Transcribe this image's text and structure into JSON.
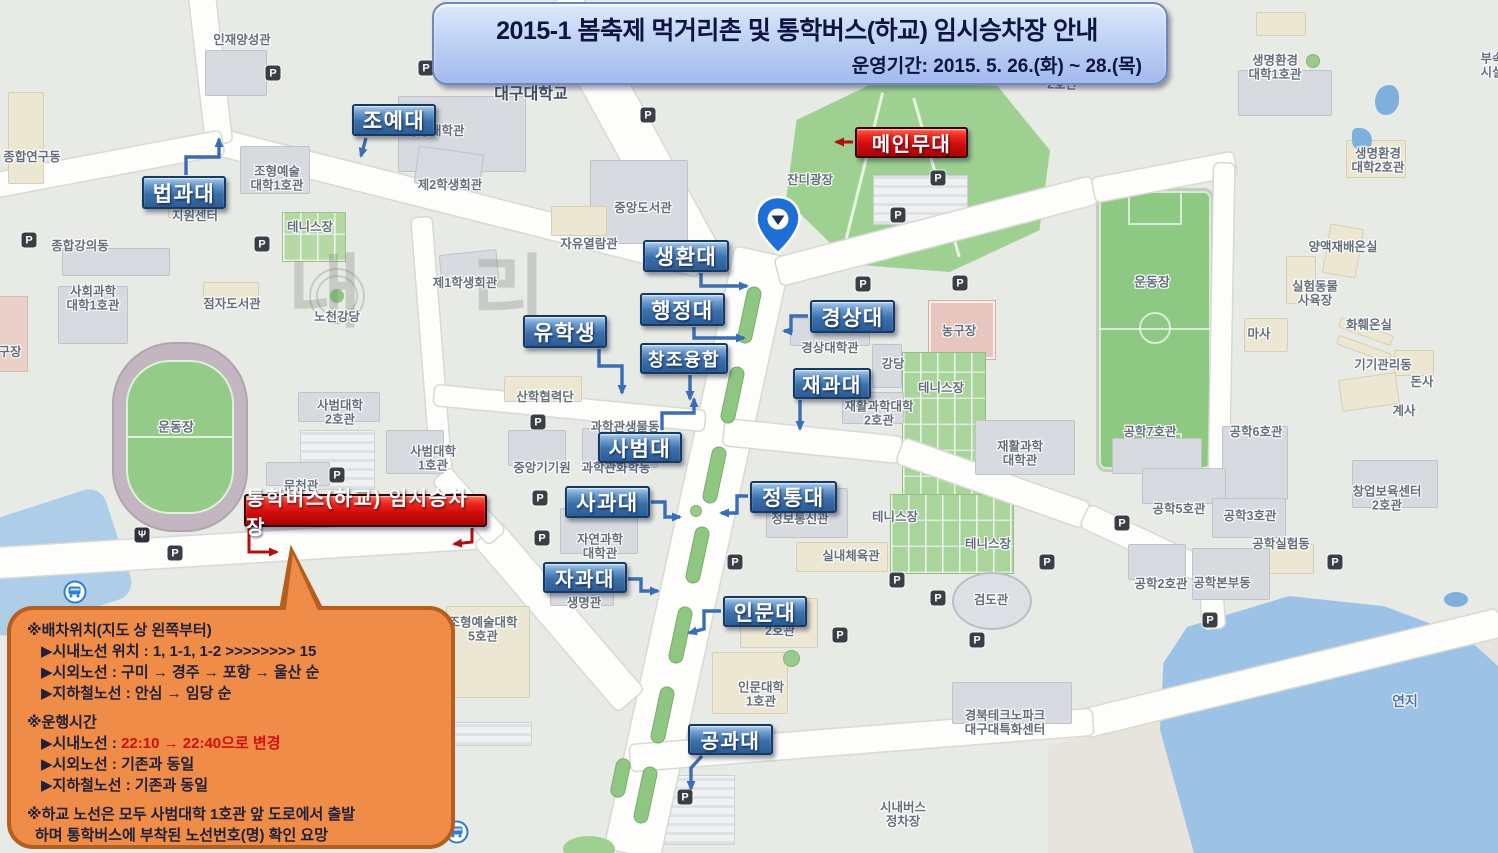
{
  "banner": {
    "title": "2015-1 봄축제 먹거리촌 및 통학버스(하교) 임시승차장 안내",
    "subtitle": "운영기간: 2015. 5. 26.(화) ~ 28.(목)"
  },
  "colors": {
    "label_blue": "#3c70aa",
    "label_red": "#d40d0d",
    "callout_orange": "#ee8c48",
    "field_green": "#8ec983",
    "water_blue": "#9cc2e6"
  },
  "overlays": {
    "blue": [
      {
        "t": "조예대",
        "x": 352,
        "y": 104,
        "w": 84,
        "h": 32
      },
      {
        "t": "법과대",
        "x": 142,
        "y": 176,
        "w": 84,
        "h": 33
      },
      {
        "t": "생환대",
        "x": 643,
        "y": 240,
        "w": 86,
        "h": 32
      },
      {
        "t": "행정대",
        "x": 640,
        "y": 293,
        "w": 85,
        "h": 33
      },
      {
        "t": "유학생",
        "x": 523,
        "y": 315,
        "w": 84,
        "h": 33
      },
      {
        "t": "창조융합",
        "x": 640,
        "y": 343,
        "w": 88,
        "h": 31,
        "fs": 18
      },
      {
        "t": "경상대",
        "x": 810,
        "y": 300,
        "w": 85,
        "h": 33
      },
      {
        "t": "재과대",
        "x": 793,
        "y": 368,
        "w": 78,
        "h": 31,
        "fs": 20
      },
      {
        "t": "사범대",
        "x": 598,
        "y": 432,
        "w": 84,
        "h": 31
      },
      {
        "t": "사과대",
        "x": 565,
        "y": 486,
        "w": 85,
        "h": 32
      },
      {
        "t": "정통대",
        "x": 750,
        "y": 481,
        "w": 87,
        "h": 32
      },
      {
        "t": "자과대",
        "x": 543,
        "y": 562,
        "w": 84,
        "h": 31,
        "fs": 20
      },
      {
        "t": "인문대",
        "x": 723,
        "y": 596,
        "w": 84,
        "h": 31
      },
      {
        "t": "공과대",
        "x": 688,
        "y": 724,
        "w": 85,
        "h": 31,
        "fs": 20
      }
    ],
    "red": [
      {
        "t": "메인무대",
        "x": 855,
        "y": 127,
        "w": 113,
        "h": 31,
        "fs": 20
      },
      {
        "t": "통학버스(하교) 임시승차장",
        "x": 244,
        "y": 494,
        "w": 243,
        "h": 33,
        "fs": 20
      }
    ]
  },
  "arrows": {
    "blue": [
      [
        [
          366,
          138
        ],
        [
          361,
          156
        ]
      ],
      [
        [
          186,
          175
        ],
        [
          186,
          157
        ],
        [
          219,
          157
        ],
        [
          219,
          139
        ]
      ],
      [
        [
          701,
          273
        ],
        [
          701,
          286
        ],
        [
          747,
          286
        ]
      ],
      [
        [
          694,
          327
        ],
        [
          694,
          338
        ],
        [
          744,
          338
        ]
      ],
      [
        [
          599,
          349
        ],
        [
          599,
          366
        ],
        [
          622,
          366
        ],
        [
          622,
          393
        ]
      ],
      [
        [
          690,
          375
        ],
        [
          690,
          399
        ]
      ],
      [
        [
          808,
          316
        ],
        [
          791,
          316
        ],
        [
          791,
          331
        ],
        [
          784,
          331
        ]
      ],
      [
        [
          800,
          400
        ],
        [
          800,
          429
        ]
      ],
      [
        [
          662,
          430
        ],
        [
          662,
          413
        ],
        [
          694,
          413
        ],
        [
          694,
          399
        ]
      ],
      [
        [
          651,
          502
        ],
        [
          665,
          502
        ],
        [
          665,
          517
        ],
        [
          680,
          517
        ]
      ],
      [
        [
          748,
          496
        ],
        [
          737,
          496
        ],
        [
          737,
          513
        ],
        [
          721,
          513
        ]
      ],
      [
        [
          628,
          579
        ],
        [
          641,
          579
        ],
        [
          641,
          591
        ],
        [
          658,
          591
        ]
      ],
      [
        [
          721,
          611
        ],
        [
          704,
          611
        ],
        [
          704,
          629
        ],
        [
          689,
          633
        ]
      ],
      [
        [
          702,
          756
        ],
        [
          691,
          768
        ],
        [
          691,
          789
        ]
      ]
    ],
    "red": [
      [
        [
          853,
          142
        ],
        [
          836,
          142
        ]
      ],
      [
        [
          249,
          528
        ],
        [
          249,
          552
        ],
        [
          277,
          552
        ]
      ],
      [
        [
          472,
          528
        ],
        [
          472,
          542
        ],
        [
          454,
          544
        ]
      ]
    ]
  },
  "callout": {
    "lines": [
      {
        "seg": [
          {
            "t": "※배차위치(지도 상 왼쪽부터)"
          }
        ]
      },
      {
        "seg": [
          {
            "t": "▶시내노선 위치 : 1, 1-1, 1-2 >>>>>>>> 15"
          }
        ],
        "indent": true
      },
      {
        "seg": [
          {
            "t": "▶시외노선 : 구미 → 경주 → 포항 → 울산 순"
          }
        ],
        "indent": true
      },
      {
        "seg": [
          {
            "t": "▶지하철노선 : 안심 → 임당 순"
          }
        ],
        "indent": true
      },
      {
        "seg": [
          {
            "t": "※운행시간"
          }
        ],
        "gap": true
      },
      {
        "seg": [
          {
            "t": "▶시내노선 : "
          },
          {
            "t": "22:10 → 22:40으로 변경",
            "red": true
          }
        ],
        "indent": true
      },
      {
        "seg": [
          {
            "t": "▶시외노선 : 기존과 동일"
          }
        ],
        "indent": true
      },
      {
        "seg": [
          {
            "t": "▶지하철노선 : 기존과 동일"
          }
        ],
        "indent": true
      },
      {
        "seg": [
          {
            "t": "※하교 노선은 모두 사범대학 1호관 앞 도로에서 출발"
          }
        ],
        "gap": true
      },
      {
        "seg": [
          {
            "t": "하며 통학버스에 부착된 노선번호(명) 확인 요망"
          }
        ],
        "hang": true
      }
    ]
  },
  "map": {
    "watermark": "내 리",
    "parking_letter": "P",
    "restaurant_glyph": "Ψ",
    "labels": [
      {
        "t": "대구대학교",
        "x": 531,
        "y": 95,
        "fs": 16,
        "c": "#3f4f63"
      },
      {
        "t": "인재양성관",
        "x": 242,
        "y": 40
      },
      {
        "t": "신애학사\n3호관",
        "x": 676,
        "y": 42
      },
      {
        "t": "조형예술대학\n2호관",
        "x": 1062,
        "y": 78
      },
      {
        "t": "법행정대학관",
        "x": 430,
        "y": 131
      },
      {
        "t": "종합연구동",
        "x": 32,
        "y": 157
      },
      {
        "t": "조형예술\n대학1호관",
        "x": 277,
        "y": 179
      },
      {
        "t": "지원센터",
        "x": 195,
        "y": 216
      },
      {
        "t": "제2학생회관",
        "x": 450,
        "y": 185
      },
      {
        "t": "테니스장",
        "x": 310,
        "y": 227
      },
      {
        "t": "종합강의동",
        "x": 80,
        "y": 246
      },
      {
        "t": "사회과학\n대학1호관",
        "x": 93,
        "y": 299
      },
      {
        "t": "점자도서관",
        "x": 232,
        "y": 304
      },
      {
        "t": "노천강당",
        "x": 337,
        "y": 317
      },
      {
        "t": "제1학생회관",
        "x": 465,
        "y": 283
      },
      {
        "t": "중앙도서관",
        "x": 643,
        "y": 208
      },
      {
        "t": "자유열람관",
        "x": 589,
        "y": 244
      },
      {
        "t": "잔디광장",
        "x": 810,
        "y": 180
      },
      {
        "t": "구장",
        "x": 10,
        "y": 352
      },
      {
        "t": "운동장",
        "x": 176,
        "y": 428,
        "fs": 13
      },
      {
        "t": "사범대학\n2호관",
        "x": 340,
        "y": 413
      },
      {
        "t": "사범대학\n1호관",
        "x": 433,
        "y": 459
      },
      {
        "t": "문천관",
        "x": 301,
        "y": 486
      },
      {
        "t": "산학협력단",
        "x": 545,
        "y": 397
      },
      {
        "t": "중앙기기원",
        "x": 542,
        "y": 468
      },
      {
        "t": "과학관화학동",
        "x": 616,
        "y": 468
      },
      {
        "t": "과학관생물동",
        "x": 625,
        "y": 427
      },
      {
        "t": "자연과학\n대학관",
        "x": 600,
        "y": 547
      },
      {
        "t": "생명관",
        "x": 584,
        "y": 603
      },
      {
        "t": "조형예술대학\n5호관",
        "x": 483,
        "y": 630
      },
      {
        "t": "경상대학관",
        "x": 830,
        "y": 348
      },
      {
        "t": "강당",
        "x": 893,
        "y": 364
      },
      {
        "t": "농구장",
        "x": 959,
        "y": 331
      },
      {
        "t": "테니스장",
        "x": 941,
        "y": 388
      },
      {
        "t": "재활과학대학\n2호관",
        "x": 879,
        "y": 414
      },
      {
        "t": "재활과학\n대학관",
        "x": 1020,
        "y": 454
      },
      {
        "t": "정보통신관",
        "x": 800,
        "y": 519
      },
      {
        "t": "테니스장",
        "x": 895,
        "y": 517
      },
      {
        "t": "테니스장",
        "x": 988,
        "y": 544
      },
      {
        "t": "실내체육관",
        "x": 851,
        "y": 556
      },
      {
        "t": "검도관",
        "x": 991,
        "y": 600
      },
      {
        "t": "2호관",
        "x": 780,
        "y": 631
      },
      {
        "t": "인문대학\n1호관",
        "x": 761,
        "y": 695
      },
      {
        "t": "경북테크노파크\n대구대특화센터",
        "x": 1005,
        "y": 723
      },
      {
        "t": "시내버스\n정차장",
        "x": 903,
        "y": 815
      },
      {
        "t": "운동장",
        "x": 1152,
        "y": 283,
        "fs": 13
      },
      {
        "t": "양액재배온실",
        "x": 1343,
        "y": 247
      },
      {
        "t": "실험동물\n사육장",
        "x": 1315,
        "y": 294
      },
      {
        "t": "마사",
        "x": 1259,
        "y": 334
      },
      {
        "t": "화훼온실",
        "x": 1369,
        "y": 325
      },
      {
        "t": "기기관리동",
        "x": 1383,
        "y": 365
      },
      {
        "t": "돈사",
        "x": 1422,
        "y": 382
      },
      {
        "t": "계사",
        "x": 1404,
        "y": 411
      },
      {
        "t": "생명환경\n대학1호관",
        "x": 1275,
        "y": 68
      },
      {
        "t": "생명환경\n대학2호관",
        "x": 1378,
        "y": 161
      },
      {
        "t": "부속\n시설",
        "x": 1492,
        "y": 66
      },
      {
        "t": "공학7호관",
        "x": 1150,
        "y": 432
      },
      {
        "t": "공학6호관",
        "x": 1256,
        "y": 432
      },
      {
        "t": "공학5호관",
        "x": 1179,
        "y": 509
      },
      {
        "t": "공학3호관",
        "x": 1250,
        "y": 516
      },
      {
        "t": "창업보육센터\n2호관",
        "x": 1387,
        "y": 499
      },
      {
        "t": "공학실험동",
        "x": 1281,
        "y": 544
      },
      {
        "t": "공학2호관",
        "x": 1161,
        "y": 584
      },
      {
        "t": "공학본부동",
        "x": 1222,
        "y": 583
      },
      {
        "t": "연지",
        "x": 1405,
        "y": 701,
        "fs": 14,
        "c": "#4f73a8"
      }
    ],
    "parking": [
      [
        29,
        240
      ],
      [
        273,
        73
      ],
      [
        426,
        68
      ],
      [
        262,
        244
      ],
      [
        648,
        115
      ],
      [
        938,
        178
      ],
      [
        898,
        215
      ],
      [
        863,
        284
      ],
      [
        960,
        283
      ],
      [
        538,
        422
      ],
      [
        540,
        498
      ],
      [
        542,
        538
      ],
      [
        337,
        475
      ],
      [
        175,
        553
      ],
      [
        735,
        562
      ],
      [
        897,
        580
      ],
      [
        938,
        598
      ],
      [
        840,
        635
      ],
      [
        1047,
        562
      ],
      [
        977,
        640
      ],
      [
        685,
        797
      ],
      [
        1122,
        523
      ],
      [
        1335,
        562
      ],
      [
        1210,
        620
      ]
    ],
    "bus_stops": [
      [
        75,
        592
      ],
      [
        457,
        832
      ]
    ],
    "restaurant": [
      142,
      535
    ]
  }
}
